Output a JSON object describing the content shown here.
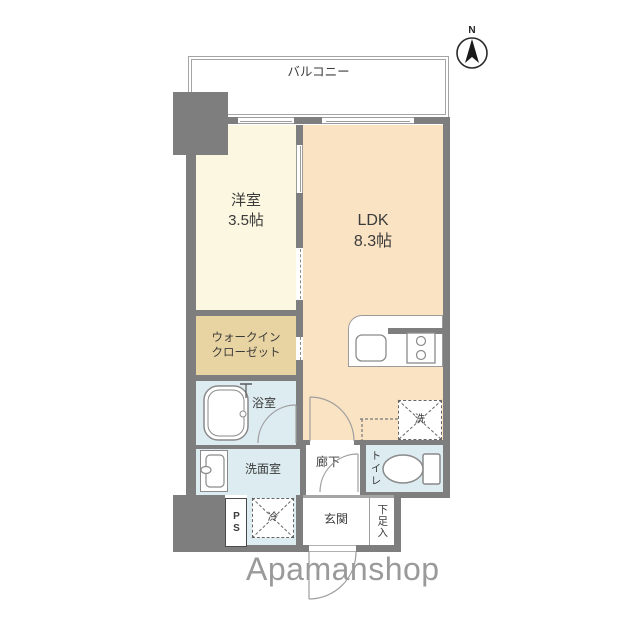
{
  "compass": {
    "label": "N"
  },
  "logo": {
    "text": "Apamanshop"
  },
  "rooms": {
    "balcony": {
      "label": "バルコニー"
    },
    "bedroom": {
      "name": "洋室",
      "size": "3.5帖"
    },
    "ldk": {
      "name": "LDK",
      "size": "8.3帖"
    },
    "wic": {
      "line1": "ウォークイン",
      "line2": "クローゼット"
    },
    "bath": {
      "label": "浴室"
    },
    "washroom": {
      "label": "洗面室"
    },
    "hallway": {
      "label": "廊下"
    },
    "toilet": {
      "label": "トイレ"
    },
    "entrance": {
      "label": "玄関"
    },
    "shoe_box": {
      "label": "下足入"
    },
    "pipe_space": {
      "label": "PS"
    },
    "fridge": {
      "label": "冷"
    },
    "washer": {
      "label": "洗"
    }
  },
  "colors": {
    "wall": "#7e7e7e",
    "bedroom": "#fbf7e0",
    "ldk": "#fae3c3",
    "walk_in_closet": "#e8d3a2",
    "wet_area": "#dcecf1",
    "logo_gray": "#9a9a9a"
  }
}
